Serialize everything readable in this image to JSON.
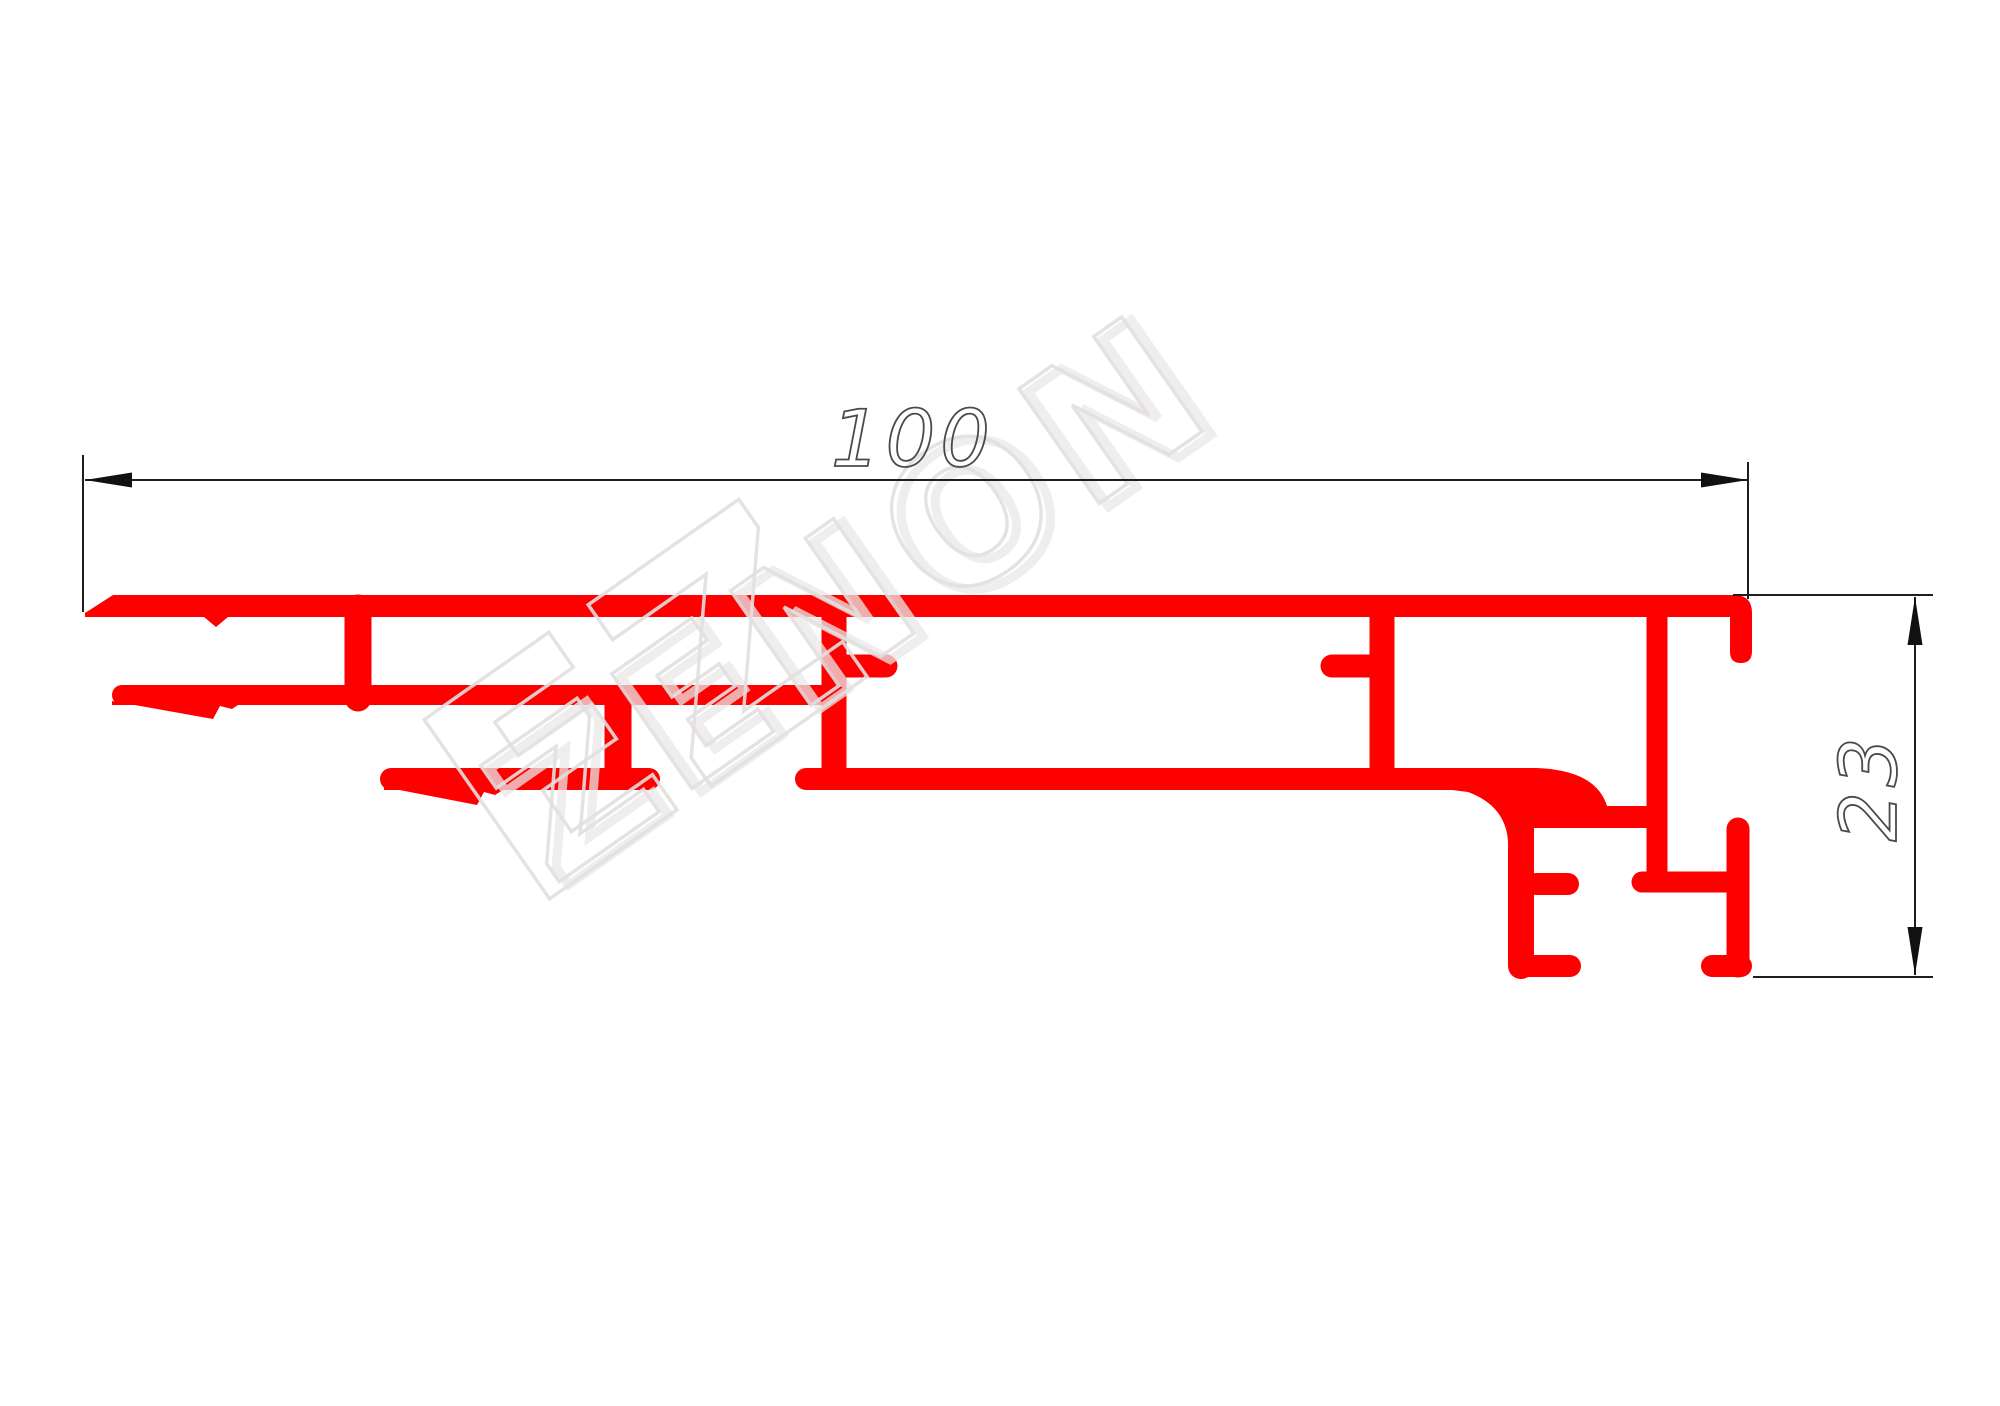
{
  "page": {
    "background": "#ffffff",
    "description": "Technical CAD drawing of an extruded aluminium profile cross-section"
  },
  "drawing": {
    "profile_color": "#fe0000",
    "line_color": "#1e1e1e",
    "arrow_color": "#111111",
    "text_color": "#4a4a4a"
  },
  "dimensions": {
    "horizontal": {
      "label": "100",
      "orientation": "horizontal"
    },
    "vertical": {
      "label": "23",
      "orientation": "vertical"
    }
  },
  "watermark": {
    "text": "ZENON",
    "monogram": "EZ",
    "color": "rgba(226,223,223,0.9)",
    "echo_color": "rgba(234,231,231,0.75)"
  }
}
